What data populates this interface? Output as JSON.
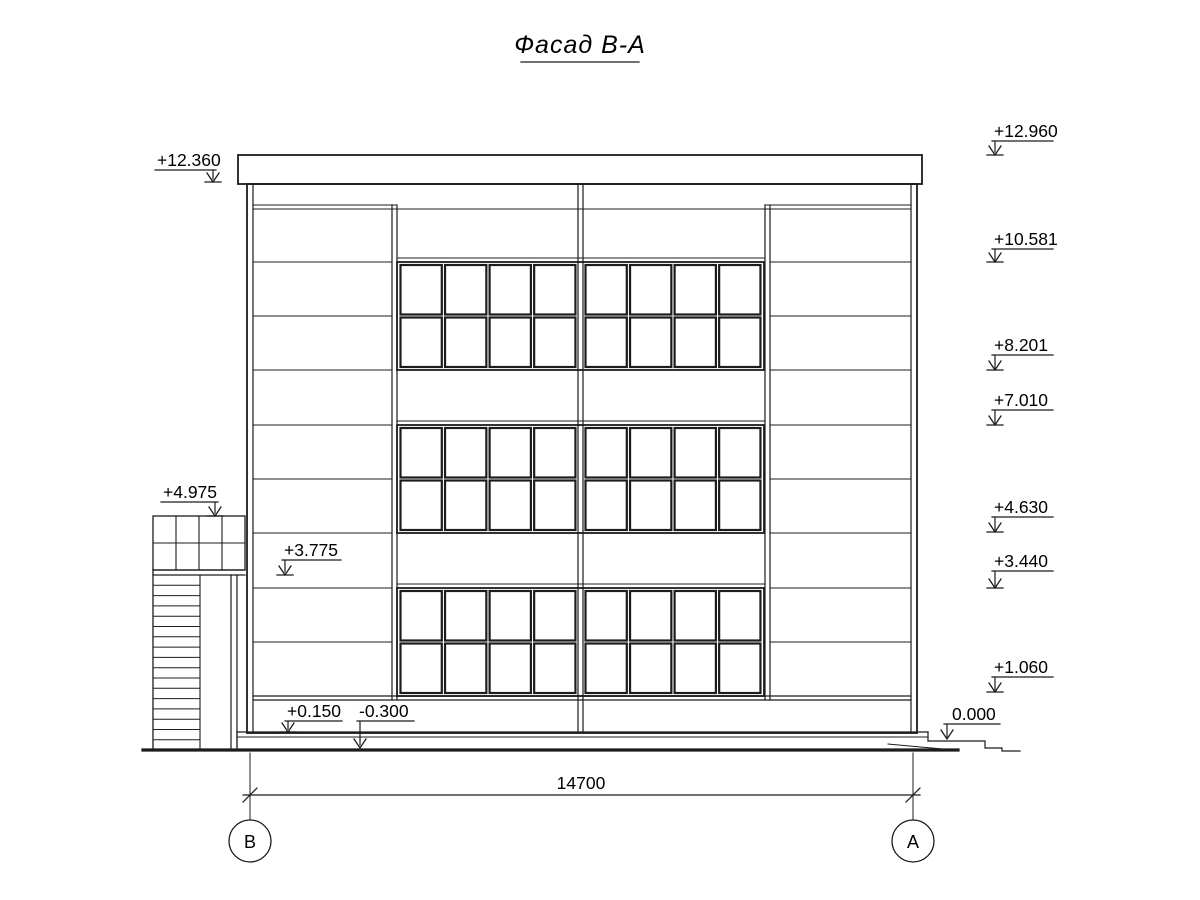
{
  "title": "Фасад В-А",
  "colors": {
    "line": "#1c1c1c",
    "background": "#ffffff"
  },
  "elevation_marks": {
    "left": [
      {
        "label": "+12.360"
      },
      {
        "label": "+4.975"
      },
      {
        "label": "+3.775"
      },
      {
        "label": "+0.150"
      },
      {
        "label": "-0.300"
      }
    ],
    "right": [
      {
        "label": "+12.960"
      },
      {
        "label": "+10.581"
      },
      {
        "label": "+8.201"
      },
      {
        "label": "+7.010"
      },
      {
        "label": "+4.630"
      },
      {
        "label": "+3.440"
      },
      {
        "label": "+1.060"
      },
      {
        "label": "0.000"
      }
    ]
  },
  "dimension": {
    "label": "14700"
  },
  "axes": [
    {
      "label": "В"
    },
    {
      "label": "А"
    }
  ]
}
